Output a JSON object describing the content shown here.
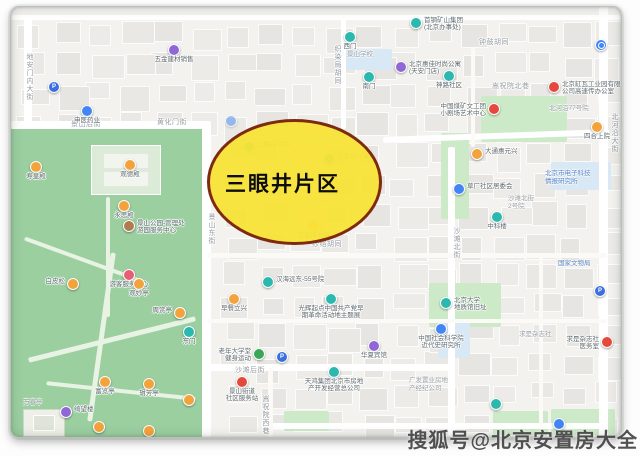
{
  "overlay": {
    "label": "三眼井片区",
    "fill": "#f8e22d",
    "fill_opacity": 0.9,
    "border_color": "#7e2a0e"
  },
  "watermark": {
    "text": "搜狐号@北京安置房大全"
  },
  "map_colors": {
    "base": "#f3f2ef",
    "park_green": "#9bcfa0",
    "light_green": "#cdeac8",
    "light_blue": "#d9e8f5",
    "street_white": "#ffffff"
  },
  "pin_colors": {
    "teal": "#2bb8ae",
    "orange": "#f2a33c",
    "purple": "#9067d6",
    "blue": "#4285f4",
    "red": "#e5493d",
    "green": "#3aa757",
    "pblue": "#3b6fe0",
    "brown": "#b07b4f",
    "pink": "#e85d75"
  },
  "street_labels": [
    {
      "t": "景山后街",
      "x": 60,
      "y": 112
    },
    {
      "t": "黄化门街",
      "x": 146,
      "y": 110
    },
    {
      "t": "地安门内大街",
      "x": 13,
      "y": 46,
      "v": 1
    },
    {
      "t": "景山东街",
      "x": 195,
      "y": 206,
      "v": 1
    },
    {
      "t": "织染局胡同",
      "x": 321,
      "y": 38,
      "v": 1
    },
    {
      "t": "钟鼓胡同",
      "x": 468,
      "y": 30
    },
    {
      "t": "嵩祝院北巷",
      "x": 481,
      "y": 74
    },
    {
      "t": "沙滩北街",
      "x": 440,
      "y": 220,
      "v": 1
    },
    {
      "t": "纱络胡同",
      "x": 301,
      "y": 232
    },
    {
      "t": "沙滩后街",
      "x": 224,
      "y": 358
    },
    {
      "t": "嵩祝院西巷",
      "x": 249,
      "y": 388,
      "v": 1
    },
    {
      "t": "北河沿大街",
      "x": 598,
      "y": 106,
      "v": 1
    }
  ],
  "area_labels": [
    {
      "t": "国家文物局",
      "x": 547,
      "y": 253,
      "blue": 1
    },
    {
      "t": "北京市电子科技\n情报研究所",
      "x": 534,
      "y": 163,
      "blue": 1
    },
    {
      "t": "沙滩北街\n2号院",
      "x": 497,
      "y": 188
    },
    {
      "t": "北河沿77号院",
      "x": 538,
      "y": 98
    },
    {
      "t": "求是杂志社",
      "x": 508,
      "y": 324
    },
    {
      "t": "景山学校",
      "x": 336,
      "y": 44
    },
    {
      "t": "万春亭",
      "x": 12,
      "y": 392
    },
    {
      "t": "广发置业房地\n产经纪公司",
      "x": 398,
      "y": 370
    }
  ],
  "pois": [
    {
      "x": 163,
      "y": 43,
      "c": "purple",
      "t": "五金建材销售",
      "p": "b"
    },
    {
      "x": 43,
      "y": 80,
      "c": "pblue",
      "t": "",
      "icon": "P"
    },
    {
      "x": 76,
      "y": 104,
      "c": "blue",
      "t": "申医药业",
      "p": "b"
    },
    {
      "x": 339,
      "y": 30,
      "c": "teal",
      "t": "西门",
      "p": "b"
    },
    {
      "x": 358,
      "y": 70,
      "c": "teal",
      "t": "南门",
      "p": "b"
    },
    {
      "x": 390,
      "y": 60,
      "c": "purple",
      "t": "北京惠佳时尚公寓\n(天安门店)",
      "p": "r"
    },
    {
      "x": 405,
      "y": 16,
      "c": "teal",
      "t": "首钢矿山集团\n(北京办事处)",
      "p": "r"
    },
    {
      "x": 590,
      "y": 38,
      "c": "blue",
      "t": "",
      "icon": "ring"
    },
    {
      "x": 438,
      "y": 69,
      "c": "teal",
      "t": "神路社区",
      "p": "b"
    },
    {
      "x": 543,
      "y": 80,
      "c": "red",
      "t": "北京缸瓦工业园有限\n公司高速传办公室",
      "p": "r"
    },
    {
      "x": 483,
      "y": 102,
      "c": "red",
      "t": "中国煤矿文工团\n小剧场艺术中心",
      "p": "l"
    },
    {
      "x": 586,
      "y": 120,
      "c": "orange",
      "t": "四合上院",
      "p": "b"
    },
    {
      "x": 466,
      "y": 147,
      "c": "orange",
      "t": "大通惠元兴",
      "p": "r"
    },
    {
      "x": 448,
      "y": 182,
      "c": "blue",
      "t": "草厂社区居委会",
      "p": "r"
    },
    {
      "x": 486,
      "y": 210,
      "c": "teal",
      "t": "中科楼",
      "p": "b"
    },
    {
      "x": 25,
      "y": 160,
      "c": "orange",
      "t": "寿皇殿",
      "p": "b"
    },
    {
      "x": 119,
      "y": 158,
      "c": "orange",
      "t": "观德殿",
      "p": "b"
    },
    {
      "x": 113,
      "y": 199,
      "c": "orange",
      "t": "永思殿",
      "p": "b"
    },
    {
      "x": 118,
      "y": 219,
      "c": "brown",
      "t": "景山公园-管理处\n游园服务中心",
      "p": "r"
    },
    {
      "x": 118,
      "y": 268,
      "c": "pink",
      "t": "游客服务中心",
      "p": "b"
    },
    {
      "x": 62,
      "y": 277,
      "c": "orange",
      "t": "白皮松",
      "p": "l"
    },
    {
      "x": 128,
      "y": 277,
      "c": "orange",
      "t": "观妙亭",
      "p": "b"
    },
    {
      "x": 169,
      "y": 306,
      "c": "orange",
      "t": "周赏亭",
      "p": "l"
    },
    {
      "x": 178,
      "y": 325,
      "c": "teal",
      "t": "东门",
      "p": "b"
    },
    {
      "x": 94,
      "y": 375,
      "c": "orange",
      "t": "富览亭",
      "p": "b"
    },
    {
      "x": 138,
      "y": 377,
      "c": "orange",
      "t": "辑芳亭",
      "p": "b"
    },
    {
      "x": 55,
      "y": 405,
      "c": "purple",
      "t": "绮望楼",
      "p": "r"
    },
    {
      "x": 178,
      "y": 393,
      "c": "orange",
      "t": ""
    },
    {
      "x": 257,
      "y": 275,
      "c": "teal",
      "t": "汉海远东-55号院",
      "p": "r"
    },
    {
      "x": 223,
      "y": 292,
      "c": "orange",
      "t": "早餐立兴",
      "p": "b"
    },
    {
      "x": 320,
      "y": 292,
      "c": "teal",
      "t": "光辉起点中国共产党早\n期革命活动地主题展",
      "p": "b"
    },
    {
      "x": 435,
      "y": 296,
      "c": "teal",
      "t": "北京大学\n地质馆旧址",
      "p": "r"
    },
    {
      "x": 430,
      "y": 322,
      "c": "blue",
      "t": "中国社会科学院\n近代史研究所",
      "p": "b"
    },
    {
      "x": 596,
      "y": 335,
      "c": "red",
      "t": "求是杂志社\n医务室",
      "p": "l"
    },
    {
      "x": 589,
      "y": 284,
      "c": "pblue",
      "t": "",
      "icon": "P"
    },
    {
      "x": 323,
      "y": 365,
      "c": "teal",
      "t": "天鸿集团北京市房地\n产开发经营总公司",
      "p": "b"
    },
    {
      "x": 231,
      "y": 375,
      "c": "red",
      "t": "景山街道\n社区服务站",
      "p": "b"
    },
    {
      "x": 248,
      "y": 347,
      "c": "green",
      "t": "老年大学堂\n健身运动",
      "p": "l"
    },
    {
      "x": 271,
      "y": 350,
      "c": "pblue",
      "t": "",
      "icon": "P"
    },
    {
      "x": 363,
      "y": 339,
      "c": "purple",
      "t": "华夏宾馆",
      "p": "b"
    },
    {
      "x": 485,
      "y": 397,
      "c": "teal",
      "t": ""
    },
    {
      "x": 548,
      "y": 417,
      "c": "blue",
      "t": ""
    },
    {
      "x": 88,
      "y": 420,
      "c": "orange",
      "t": ""
    },
    {
      "x": 138,
      "y": 424,
      "c": "orange",
      "t": ""
    },
    {
      "x": 220,
      "y": 114,
      "c": "blue",
      "t": "",
      "faint": 1
    },
    {
      "x": 238,
      "y": 140,
      "c": "teal",
      "t": "三眼井胡同",
      "p": "r",
      "faint": 1
    },
    {
      "x": 318,
      "y": 152,
      "c": "teal",
      "t": "吉安所左巷",
      "p": "r",
      "faint": 1
    },
    {
      "x": 303,
      "y": 219,
      "c": "orange",
      "t": "吉安所右巷",
      "p": "b",
      "faint": 1
    }
  ]
}
